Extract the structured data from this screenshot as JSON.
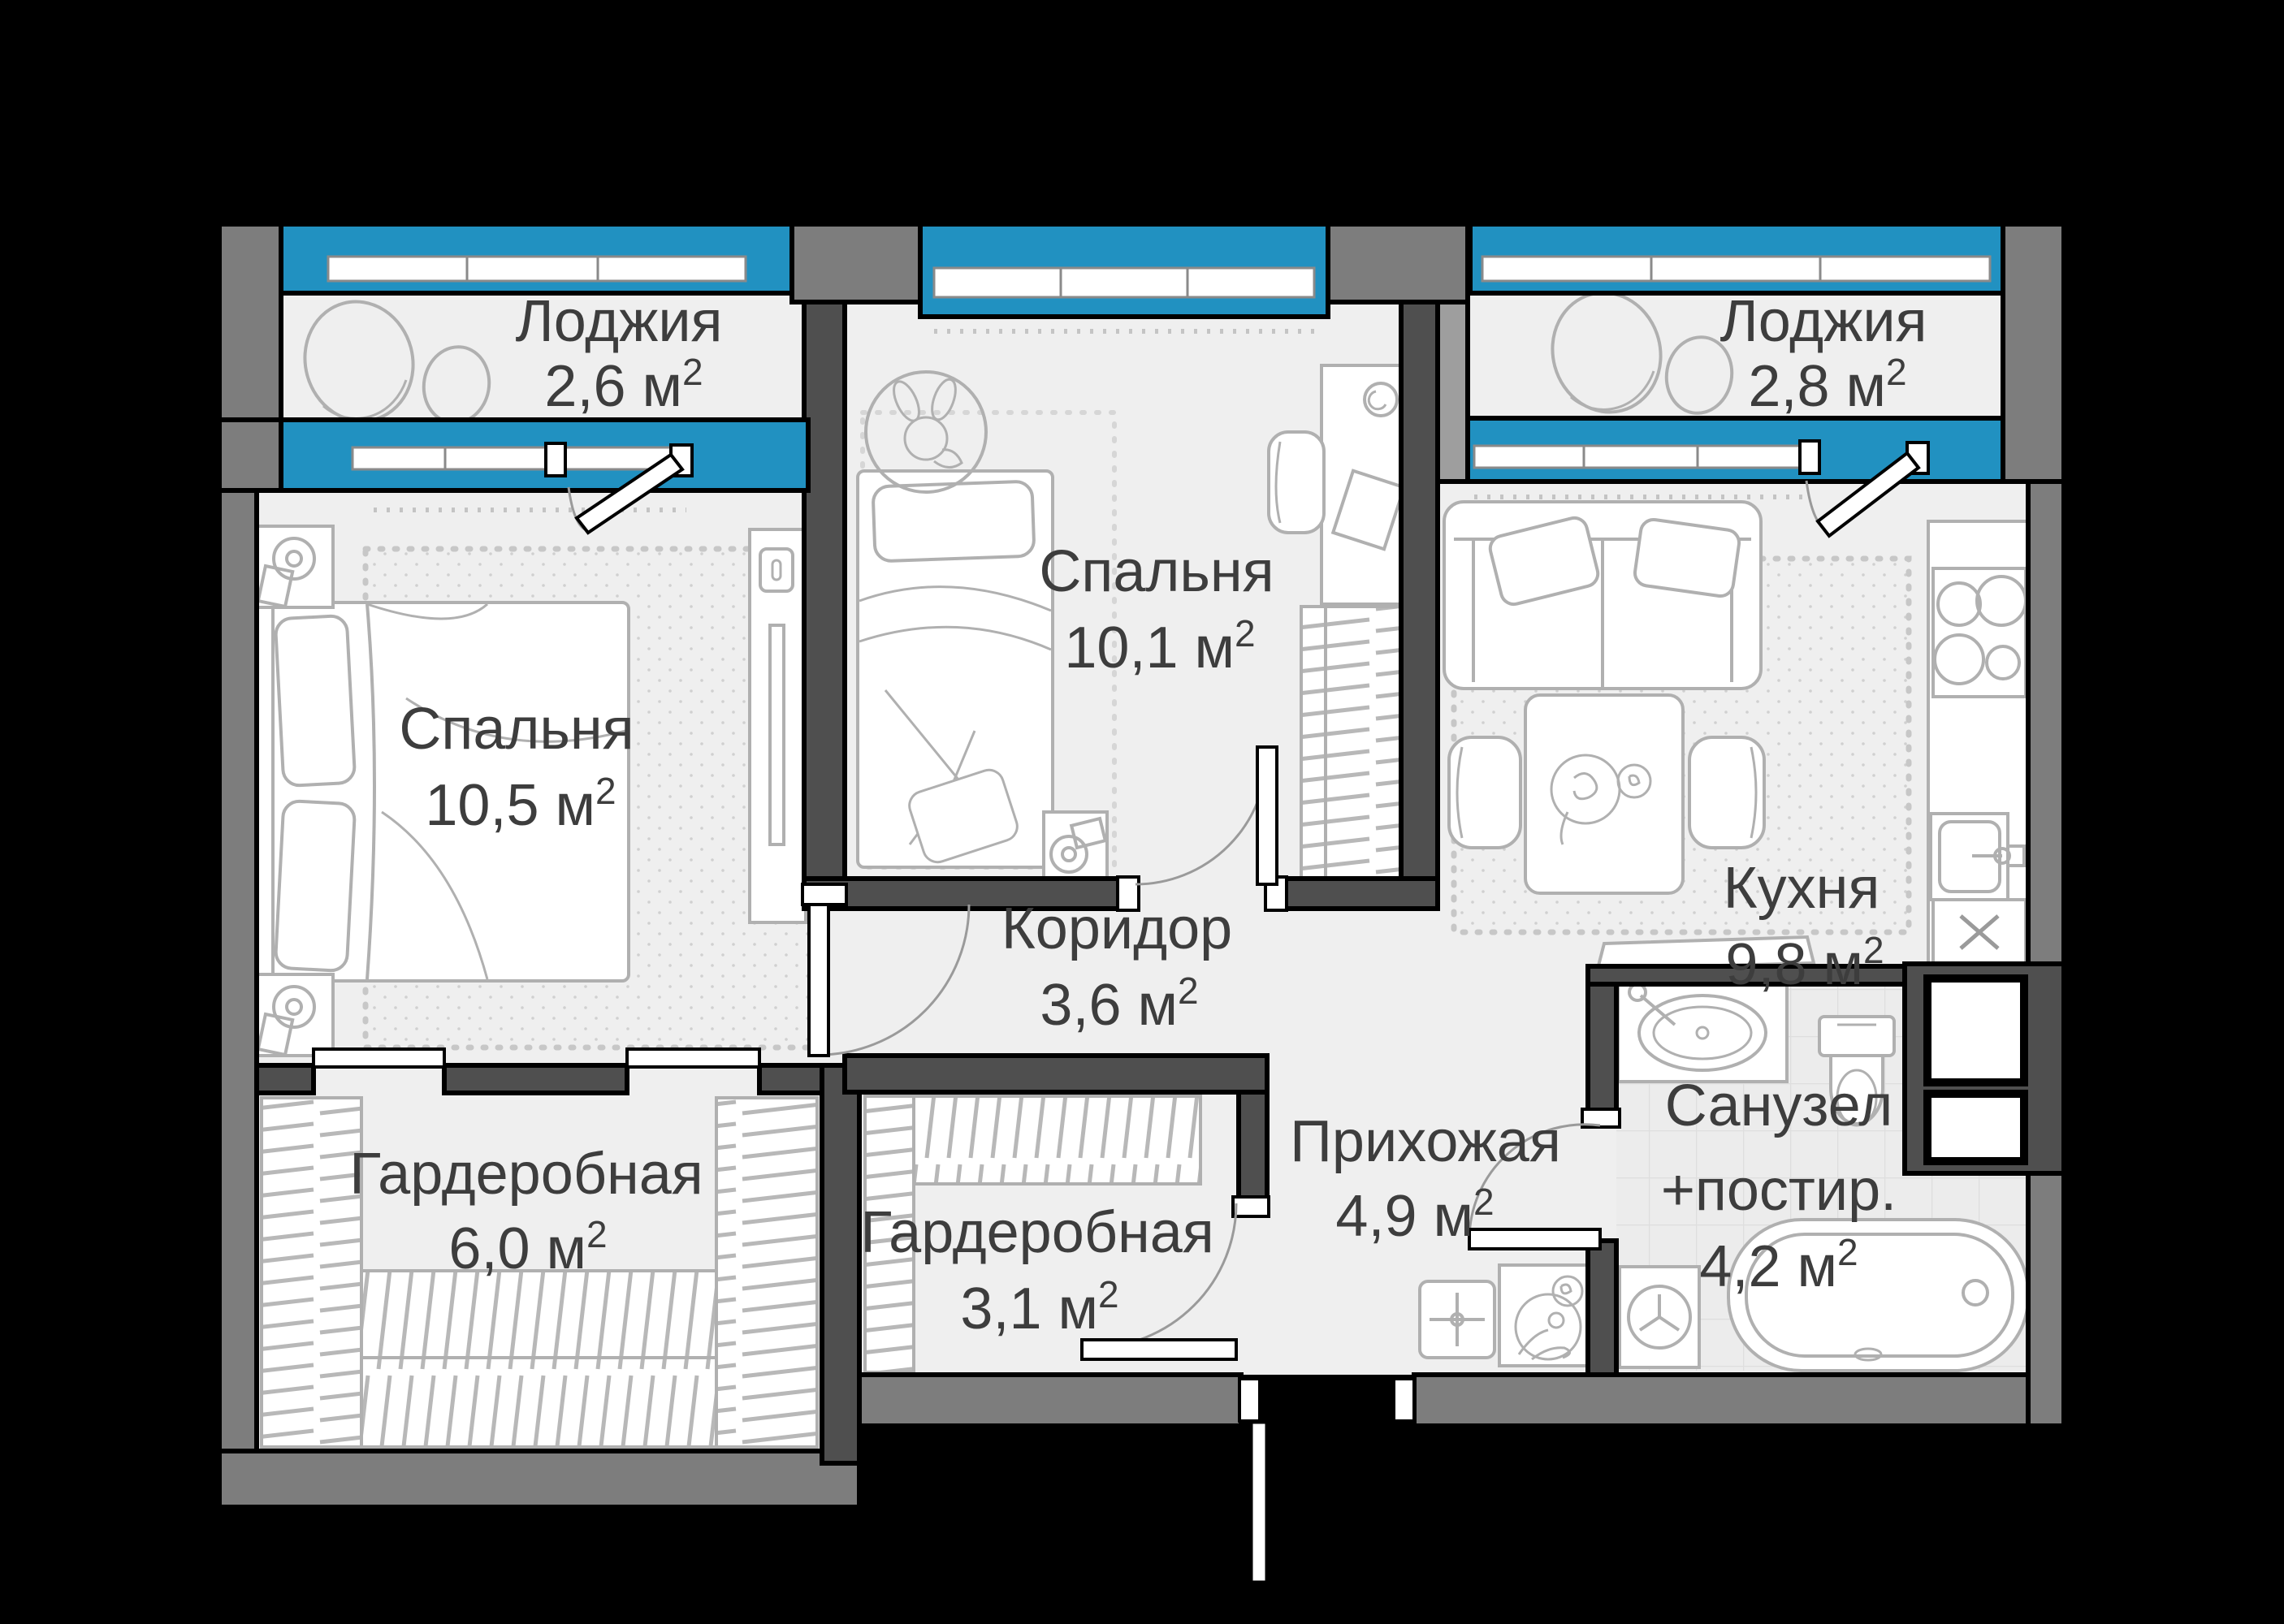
{
  "plan": {
    "background": "#000000",
    "floor_color": "#efefef",
    "window_color": "#2191c1",
    "wall_dark": "#4f4f4f",
    "wall_mid": "#7d7d7d",
    "wall_light": "#9e9e9e",
    "furniture_line": "#b0b0b0",
    "text_color": "#3d3d3d"
  },
  "superscript": "2",
  "rooms": [
    {
      "id": "loggia-left",
      "name": "Лоджия",
      "area": "2,6 м"
    },
    {
      "id": "bedroom-middle",
      "name": "Спальня",
      "area": "10,1 м"
    },
    {
      "id": "loggia-right",
      "name": "Лоджия",
      "area": "2,8 м"
    },
    {
      "id": "bedroom-left",
      "name": "Спальня",
      "area": "10,5 м"
    },
    {
      "id": "kitchen",
      "name": "Кухня",
      "area": "9,8 м"
    },
    {
      "id": "corridor",
      "name": "Коридор",
      "area": "3,6 м"
    },
    {
      "id": "wardrobe-left",
      "name": "Гардеробная",
      "area": "6,0 м"
    },
    {
      "id": "wardrobe-middle",
      "name": "Гардеробная",
      "area": "3,1 м"
    },
    {
      "id": "hallway",
      "name": "Прихожая",
      "area": "4,9 м"
    },
    {
      "id": "bathroom",
      "name": "Санузел",
      "name2": "+постир.",
      "area": "4,2 м"
    }
  ]
}
